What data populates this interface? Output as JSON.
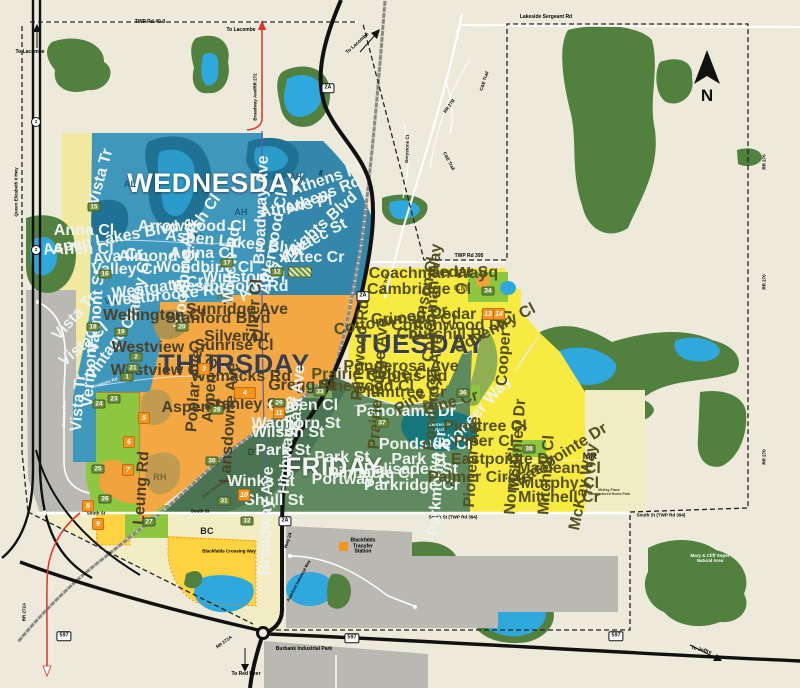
{
  "compass": {
    "label": "N"
  },
  "colors": {
    "background": "#edeadc",
    "wednesday": "#4097bc",
    "thursday": "#f3a844",
    "tuesday": "#f7ea41",
    "friday": "#5f8a5f",
    "forest": "#52803e",
    "water": "#2fa8dd",
    "industrial": "#b9b8b3",
    "lime_zone": "#8dc63f",
    "gold": "#ffd23f",
    "marker_green": "#6f8f3e",
    "marker_orange": "#f7941e",
    "highway": "#111111",
    "route_red": "#e03127"
  },
  "day_labels": [
    {
      "t": "WEDNESDAY",
      "x": 216,
      "y": 183,
      "s": 27,
      "c": "#fcfdfd",
      "k": "day-light"
    },
    {
      "t": "THURSDAY",
      "x": 234,
      "y": 364,
      "s": 27,
      "c": "#3a3d4c",
      "k": "day-dark"
    },
    {
      "t": "TUESDAY",
      "x": 420,
      "y": 344,
      "s": 27,
      "c": "#3a3d4c",
      "k": "day-dark"
    },
    {
      "t": "FRIDAY",
      "x": 334,
      "y": 467,
      "s": 26,
      "c": "#f2f5f1",
      "k": "day-light"
    }
  ],
  "area_labels": [
    {
      "t": "AL",
      "x": 130,
      "y": 184,
      "s": 9,
      "c": "#1d5c7e"
    },
    {
      "t": "AL",
      "x": 199,
      "y": 237,
      "s": 9,
      "c": "#1d5c7e"
    },
    {
      "t": "AH",
      "x": 296,
      "y": 178,
      "s": 8,
      "c": "#1d5c7e"
    },
    {
      "t": "AH",
      "x": 241,
      "y": 212,
      "s": 9,
      "c": "#1d5c7e"
    },
    {
      "t": "VR",
      "x": 111,
      "y": 301,
      "s": 9,
      "c": "#1d5c7e"
    },
    {
      "t": "HM",
      "x": 224,
      "y": 296,
      "s": 9,
      "c": "#7c6a33"
    },
    {
      "t": "RH",
      "x": 160,
      "y": 477,
      "s": 9,
      "c": "#7c6a33"
    },
    {
      "t": "DT",
      "x": 254,
      "y": 452,
      "s": 9,
      "c": "#2e4733"
    },
    {
      "t": "PE",
      "x": 429,
      "y": 404,
      "s": 9,
      "c": "#2e4733"
    },
    {
      "t": "PE",
      "x": 450,
      "y": 483,
      "s": 9,
      "c": "#2e4733"
    },
    {
      "t": "CM",
      "x": 461,
      "y": 288,
      "s": 9,
      "c": "#6e6a2c"
    },
    {
      "t": "MR",
      "x": 590,
      "y": 456,
      "s": 9,
      "c": "#1d1d1b"
    },
    {
      "t": "BC",
      "x": 207,
      "y": 531,
      "s": 9,
      "c": "#1d1d1b"
    }
  ],
  "road_labels": [
    {
      "t": "TWP Rd 40-0",
      "x": 150,
      "y": 23,
      "s": 5
    },
    {
      "t": "To Lacombe",
      "x": 30,
      "y": 53,
      "s": 5
    },
    {
      "t": "To Lacombe",
      "x": 241,
      "y": 31,
      "s": 5
    },
    {
      "t": "To Lacombe",
      "x": 358,
      "y": 44,
      "s": 5,
      "r": -42
    },
    {
      "t": "Lakeside Sergeant Rd",
      "x": 546,
      "y": 18,
      "s": 5
    },
    {
      "t": "C&E Trail",
      "x": 484,
      "y": 81,
      "s": 4.5,
      "r": -72
    },
    {
      "t": "RR 27B",
      "x": 449,
      "y": 106,
      "s": 4.5,
      "r": -55
    },
    {
      "t": "C&E Trail",
      "x": 449,
      "y": 161,
      "s": 4.5,
      "r": 62
    },
    {
      "t": "Greystone Ct",
      "x": 407,
      "y": 149,
      "s": 4.5,
      "r": -88
    },
    {
      "t": "C&E Trail",
      "x": 385,
      "y": 284,
      "s": 4.5,
      "r": -78
    },
    {
      "t": "TWP Rd 395",
      "x": 469,
      "y": 257,
      "s": 5
    },
    {
      "t": "RR 270",
      "x": 764,
      "y": 162,
      "s": 4.5,
      "r": -90
    },
    {
      "t": "RR 270",
      "x": 764,
      "y": 282,
      "s": 4.5,
      "r": -90
    },
    {
      "t": "RR 270",
      "x": 764,
      "y": 457,
      "s": 4.5,
      "r": -90
    },
    {
      "t": "Queen Elizabeth II Hwy",
      "x": 16,
      "y": 192,
      "s": 4.5,
      "r": -90
    },
    {
      "t": "Broadway Ave/RR 272",
      "x": 255,
      "y": 97,
      "s": 4.5,
      "r": -90
    },
    {
      "t": "Hwy 2A",
      "x": 320,
      "y": 178,
      "s": 4.5,
      "r": -80
    },
    {
      "t": "Hwy 2A",
      "x": 288,
      "y": 540,
      "s": 4.5,
      "r": -72
    },
    {
      "t": "South St",
      "x": 52,
      "y": 513,
      "s": 4.5,
      "c": "#ffffff"
    },
    {
      "t": "South St",
      "x": 96,
      "y": 513,
      "s": 4.5
    },
    {
      "t": "South St",
      "x": 200,
      "y": 511,
      "s": 4.5
    },
    {
      "t": "South St (TWP Rd 394)",
      "x": 453,
      "y": 517,
      "s": 4.5
    },
    {
      "t": "South St (TWP Rd 394)",
      "x": 661,
      "y": 515,
      "s": 4.5
    },
    {
      "t": "Blackfalds Crossing Way",
      "x": 229,
      "y": 551,
      "s": 4.5
    },
    {
      "t": "Burbank Industrial Park",
      "x": 304,
      "y": 650,
      "s": 5
    },
    {
      "t": "To Red Deer",
      "x": 246,
      "y": 675,
      "s": 5
    },
    {
      "t": "To Joffre",
      "x": 701,
      "y": 651,
      "s": 5,
      "r": 14
    },
    {
      "t": "RR 272A",
      "x": 24,
      "y": 612,
      "s": 4.5,
      "r": -90
    },
    {
      "t": "RR 272A",
      "x": 224,
      "y": 642,
      "s": 4.5,
      "r": -36
    },
    {
      "t": "Aspelund Industrial Way",
      "x": 299,
      "y": 581,
      "s": 4,
      "r": -62
    },
    {
      "t": "East Railway St",
      "x": 216,
      "y": 487,
      "s": 4.5,
      "r": -36,
      "c": "#4a4128"
    },
    {
      "t": "Duncan Ave",
      "x": 64,
      "y": 414,
      "s": 4.5,
      "r": -88,
      "c": "#ffffff"
    },
    {
      "t": "Womacks Rd",
      "x": 104,
      "y": 383,
      "s": 4.5,
      "r": -18,
      "c": "#eef3f0"
    },
    {
      "t": "Mary & Cliff Soper\nNatural Area",
      "x": 710,
      "y": 558,
      "s": 4.5,
      "c": "#ffffff"
    },
    {
      "t": "Blackfalds\nTransfer\nStation",
      "x": 363,
      "y": 547,
      "s": 5
    },
    {
      "t": "McKay Place\nManufactured Home Park",
      "x": 609,
      "y": 493,
      "s": 3.5,
      "c": "#4a4128"
    },
    {
      "t": "Centennial\nPark",
      "x": 440,
      "y": 427,
      "s": 4.5,
      "c": "#cfe7e3",
      "i": 1
    }
  ],
  "street_labels": [
    {
      "t": "Vista Tr",
      "x": 101,
      "y": 177,
      "r": -75,
      "c": "#eef3f0"
    },
    {
      "t": "Anna Cl",
      "x": 84,
      "y": 231,
      "c": "#eef3f0"
    },
    {
      "t": "Aspen Lakes Blvd",
      "x": 111,
      "y": 239,
      "r": -10,
      "c": "#eef3f0"
    },
    {
      "t": "Arlen Cl",
      "x": 83,
      "y": 250,
      "c": "#eef3f0"
    },
    {
      "t": "Ava Cr",
      "x": 118,
      "y": 257,
      "r": -8,
      "c": "#eef3f0"
    },
    {
      "t": "Valley Cr",
      "x": 125,
      "y": 270,
      "c": "#eef3f0"
    },
    {
      "t": "Valley Cl",
      "x": 139,
      "y": 290,
      "r": -78,
      "c": "#eef3f0"
    },
    {
      "t": "Westgate Cr",
      "x": 158,
      "y": 288,
      "r": -8,
      "c": "#eef3f0"
    },
    {
      "t": "Almond Cr",
      "x": 159,
      "y": 257,
      "c": "#eef3f0"
    },
    {
      "t": "Adina Cl",
      "x": 202,
      "y": 254,
      "c": "#eef3f0"
    },
    {
      "t": "Woodbine Cl",
      "x": 205,
      "y": 268,
      "c": "#eef3f0"
    },
    {
      "t": "Woodbine Ave",
      "x": 185,
      "y": 273,
      "r": -85,
      "c": "#eef3f0"
    },
    {
      "t": "Aspen Lakes Blvd",
      "x": 234,
      "y": 243,
      "r": 6,
      "c": "#eef3f0"
    },
    {
      "t": "Arrowwood Cl",
      "x": 192,
      "y": 227,
      "c": "#eef3f0"
    },
    {
      "t": "Ash Cl",
      "x": 203,
      "y": 217,
      "r": -55,
      "c": "#eef3f0"
    },
    {
      "t": "Willow Rd",
      "x": 232,
      "y": 265,
      "r": -85,
      "c": "#eef3f0"
    },
    {
      "t": "Winston Pl",
      "x": 244,
      "y": 278,
      "c": "#eef3f0"
    },
    {
      "t": "Westbrooke Rd",
      "x": 230,
      "y": 287,
      "c": "#eef3f0"
    },
    {
      "t": "Westbrooke Rd",
      "x": 166,
      "y": 296,
      "r": -6,
      "c": "#eef3f0"
    },
    {
      "t": "Athens Pl",
      "x": 326,
      "y": 180,
      "r": -18,
      "c": "#eef3f0"
    },
    {
      "t": "Athens Rd",
      "x": 323,
      "y": 196,
      "r": -22,
      "c": "#eef3f0"
    },
    {
      "t": "Athens Pl",
      "x": 296,
      "y": 207,
      "r": -10,
      "c": "#eef3f0"
    },
    {
      "t": "Aztec St",
      "x": 318,
      "y": 238,
      "r": -28,
      "c": "#eef3f0"
    },
    {
      "t": "Aztec Cr",
      "x": 312,
      "y": 258,
      "c": "#eef3f0"
    },
    {
      "t": "Aurora Heights Blvd",
      "x": 298,
      "y": 247,
      "r": -42,
      "c": "#eef3f0"
    },
    {
      "t": "Alderwood Cl",
      "x": 274,
      "y": 243,
      "r": -80,
      "c": "#eef3f0"
    },
    {
      "t": "Vista Tr",
      "x": 75,
      "y": 317,
      "r": -48,
      "c": "#eef3f0"
    },
    {
      "t": "Vista Cl",
      "x": 84,
      "y": 345,
      "r": -40,
      "c": "#eef3f0"
    },
    {
      "t": "Vista Tr",
      "x": 79,
      "y": 403,
      "r": -85,
      "c": "#eef3f0"
    },
    {
      "t": "Valmont St",
      "x": 97,
      "y": 311,
      "r": -86,
      "c": "#eef3f0"
    },
    {
      "t": "Vintage Cl",
      "x": 112,
      "y": 347,
      "r": -55,
      "c": "#eef3f0"
    },
    {
      "t": "Vermont Cl",
      "x": 91,
      "y": 365,
      "r": -86,
      "c": "#eef3f0"
    },
    {
      "t": "Broadway Ave",
      "x": 262,
      "y": 210,
      "r": -88,
      "c": "#eef3f0"
    },
    {
      "t": "Wellington Cl",
      "x": 154,
      "y": 316,
      "c": "#4a4128"
    },
    {
      "t": "Westview Cr",
      "x": 159,
      "y": 348,
      "c": "#4a4128"
    },
    {
      "t": "Westview Cr",
      "x": 158,
      "y": 371,
      "c": "#4a4128"
    },
    {
      "t": "Womacks Rd",
      "x": 241,
      "y": 377,
      "c": "#4a4128"
    },
    {
      "t": "Sunridge Ave",
      "x": 237,
      "y": 310,
      "c": "#4a4128"
    },
    {
      "t": "Stanford Blvd",
      "x": 218,
      "y": 319,
      "c": "#4a4128"
    },
    {
      "t": "Silver Dr",
      "x": 237,
      "y": 337,
      "c": "#4a4128"
    },
    {
      "t": "Silver Cl",
      "x": 255,
      "y": 311,
      "r": -86,
      "c": "#4a4128"
    },
    {
      "t": "Sunrise Cl",
      "x": 234,
      "y": 346,
      "c": "#4a4128"
    },
    {
      "t": "Aspen Dr",
      "x": 197,
      "y": 408,
      "c": "#4a4128"
    },
    {
      "t": "Poplar Ave",
      "x": 195,
      "y": 391,
      "r": -86,
      "c": "#4a4128"
    },
    {
      "t": "Aspen Cl",
      "x": 211,
      "y": 388,
      "r": -86,
      "c": "#4a4128"
    },
    {
      "t": "Stanley St",
      "x": 244,
      "y": 405,
      "c": "#4a4128"
    },
    {
      "t": "Lansdowne Ave",
      "x": 230,
      "y": 423,
      "r": -86,
      "c": "#4a4128"
    },
    {
      "t": "Leung Rd",
      "x": 142,
      "y": 488,
      "r": -86,
      "c": "#4a4128"
    },
    {
      "t": "Gregg St",
      "x": 302,
      "y": 386,
      "c": "#4a4128"
    },
    {
      "t": "Waghorn St",
      "x": 296,
      "y": 424,
      "c": "#eef3f0"
    },
    {
      "t": "Wilson St",
      "x": 288,
      "y": 433,
      "c": "#eef3f0"
    },
    {
      "t": "Park St",
      "x": 283,
      "y": 451,
      "c": "#eef3f0"
    },
    {
      "t": "East Ave",
      "x": 298,
      "y": 398,
      "r": -86,
      "c": "#eef3f0"
    },
    {
      "t": "Queen Cl",
      "x": 303,
      "y": 406,
      "c": "#eef3f0"
    },
    {
      "t": "Highway Ave",
      "x": 288,
      "y": 445,
      "r": -86,
      "c": "#eef3f0"
    },
    {
      "t": "Winks St",
      "x": 261,
      "y": 482,
      "c": "#eef3f0"
    },
    {
      "t": "Shull St",
      "x": 274,
      "y": 501,
      "c": "#eef3f0"
    },
    {
      "t": "Broadway Ave",
      "x": 267,
      "y": 521,
      "r": -88,
      "c": "#eef3f0"
    },
    {
      "t": "Panorama Dr",
      "x": 406,
      "y": 412,
      "c": "#eef3f0"
    },
    {
      "t": "Pondside Cr",
      "x": 426,
      "y": 445,
      "c": "#eef3f0"
    },
    {
      "t": "Park St",
      "x": 342,
      "y": 458,
      "c": "#eef3f0"
    },
    {
      "t": "Park St",
      "x": 419,
      "y": 460,
      "c": "#eef3f0"
    },
    {
      "t": "Palisades St",
      "x": 411,
      "y": 470,
      "c": "#eef3f0"
    },
    {
      "t": "Parkridge Cr",
      "x": 412,
      "y": 486,
      "c": "#eef3f0"
    },
    {
      "t": "Pinnacle Cl",
      "x": 371,
      "y": 474,
      "c": "#eef3f0"
    },
    {
      "t": "Portway Cl",
      "x": 353,
      "y": 480,
      "c": "#eef3f0"
    },
    {
      "t": "Parkmount Cr",
      "x": 438,
      "y": 483,
      "r": -86,
      "c": "#eef3f0"
    },
    {
      "t": "Pioneer Way",
      "x": 477,
      "y": 414,
      "r": -48,
      "c": "#eef3f0"
    },
    {
      "t": "Pinetree Cl",
      "x": 485,
      "y": 427,
      "c": "#55511f"
    },
    {
      "t": "Piper Cl",
      "x": 484,
      "y": 442,
      "c": "#55511f"
    },
    {
      "t": "Pioneer Ave",
      "x": 473,
      "y": 462,
      "r": -86,
      "c": "#55511f"
    },
    {
      "t": "Palmer Circle",
      "x": 479,
      "y": 478,
      "c": "#55511f"
    },
    {
      "t": "Coachman Way",
      "x": 428,
      "y": 274,
      "c": "#55511f"
    },
    {
      "t": "Cedar Sq",
      "x": 463,
      "y": 273,
      "c": "#55511f"
    },
    {
      "t": "Cedar Sq",
      "x": 466,
      "y": 315,
      "c": "#55511f"
    },
    {
      "t": "Cambridge Cl",
      "x": 419,
      "y": 290,
      "c": "#55511f"
    },
    {
      "t": "Crimson Cl",
      "x": 425,
      "y": 299,
      "r": -78,
      "c": "#55511f"
    },
    {
      "t": "Crimson Ct",
      "x": 414,
      "y": 320,
      "c": "#55511f"
    },
    {
      "t": "Coachman Way",
      "x": 433,
      "y": 303,
      "r": -86,
      "c": "#55511f"
    },
    {
      "t": "Cottonwood Dr",
      "x": 449,
      "y": 326,
      "c": "#55511f"
    },
    {
      "t": "Cottonwood Dr",
      "x": 391,
      "y": 321,
      "r": -10,
      "c": "#55511f"
    },
    {
      "t": "Churchill Pl",
      "x": 441,
      "y": 335,
      "c": "#55511f"
    },
    {
      "t": "Coventry Cl",
      "x": 495,
      "y": 329,
      "r": -28,
      "c": "#55511f"
    },
    {
      "t": "Cooper Cl",
      "x": 505,
      "y": 348,
      "r": -86,
      "c": "#55511f"
    },
    {
      "t": "Ponderosa Ave",
      "x": 401,
      "y": 367,
      "c": "#55511f"
    },
    {
      "t": "Ponderosa Ave",
      "x": 434,
      "y": 393,
      "r": -86,
      "c": "#55511f"
    },
    {
      "t": "Cyprus Rd",
      "x": 407,
      "y": 377,
      "c": "#55511f"
    },
    {
      "t": "Plumtree Cr",
      "x": 401,
      "y": 393,
      "c": "#55511f"
    },
    {
      "t": "Pinewood Rd",
      "x": 361,
      "y": 350,
      "r": -86,
      "c": "#55511f"
    },
    {
      "t": "Pinewood Cl",
      "x": 366,
      "y": 387,
      "c": "#55511f"
    },
    {
      "t": "Prairie Ridge Cl",
      "x": 371,
      "y": 375,
      "c": "#55511f"
    },
    {
      "t": "Prairie Ridge Ave",
      "x": 379,
      "y": 384,
      "r": -86,
      "c": "#55511f"
    },
    {
      "t": "Pine Cl",
      "x": 419,
      "y": 396,
      "r": -35,
      "c": "#55511f"
    },
    {
      "t": "Pine Cr",
      "x": 451,
      "y": 403,
      "r": -15,
      "c": "#55511f"
    },
    {
      "t": "Eastpointe Dr",
      "x": 503,
      "y": 460,
      "c": "#55511f"
    },
    {
      "t": "Eastpointe Dr",
      "x": 562,
      "y": 455,
      "r": -32,
      "c": "#55511f"
    },
    {
      "t": "Maclean Cl",
      "x": 559,
      "y": 469,
      "c": "#55511f"
    },
    {
      "t": "Murphy Cl",
      "x": 560,
      "y": 484,
      "c": "#55511f"
    },
    {
      "t": "Mitchell Cr",
      "x": 559,
      "y": 498,
      "c": "#55511f"
    },
    {
      "t": "Mitchell Cl",
      "x": 547,
      "y": 475,
      "r": -86,
      "c": "#55511f"
    },
    {
      "t": "Norris Cl",
      "x": 513,
      "y": 481,
      "r": -86,
      "c": "#55511f"
    },
    {
      "t": "McKay Way",
      "x": 584,
      "y": 487,
      "r": -78,
      "c": "#55511f"
    },
    {
      "t": "McKinley Dr",
      "x": 518,
      "y": 445,
      "r": -86,
      "c": "#55511f"
    }
  ],
  "markers": {
    "green": [
      {
        "n": "15",
        "x": 94,
        "y": 207
      },
      {
        "n": "16",
        "x": 105,
        "y": 274
      },
      {
        "n": "17",
        "x": 227,
        "y": 263
      },
      {
        "n": "12",
        "x": 277,
        "y": 272
      },
      {
        "n": "18",
        "x": 93,
        "y": 327
      },
      {
        "n": "19",
        "x": 121,
        "y": 332
      },
      {
        "n": "20",
        "x": 182,
        "y": 327
      },
      {
        "n": "2",
        "x": 136,
        "y": 357
      },
      {
        "n": "21",
        "x": 133,
        "y": 368
      },
      {
        "n": "1",
        "x": 127,
        "y": 377
      },
      {
        "n": "23",
        "x": 114,
        "y": 399
      },
      {
        "n": "24",
        "x": 99,
        "y": 404
      },
      {
        "n": "25",
        "x": 98,
        "y": 469
      },
      {
        "n": "26",
        "x": 105,
        "y": 499
      },
      {
        "n": "27",
        "x": 149,
        "y": 522
      },
      {
        "n": "28",
        "x": 217,
        "y": 410
      },
      {
        "n": "29",
        "x": 279,
        "y": 403
      },
      {
        "n": "30",
        "x": 212,
        "y": 461
      },
      {
        "n": "31",
        "x": 224,
        "y": 501
      },
      {
        "n": "32",
        "x": 247,
        "y": 521
      },
      {
        "n": "33",
        "x": 320,
        "y": 392
      },
      {
        "n": "34",
        "x": 488,
        "y": 291
      },
      {
        "n": "36",
        "x": 463,
        "y": 393
      },
      {
        "n": "37",
        "x": 382,
        "y": 423
      },
      {
        "n": "38",
        "x": 529,
        "y": 449
      }
    ],
    "orange": [
      {
        "n": "3",
        "x": 204,
        "y": 369
      },
      {
        "n": "4",
        "x": 245,
        "y": 393,
        "wd": 20
      },
      {
        "n": "5",
        "x": 144,
        "y": 418
      },
      {
        "n": "6",
        "x": 129,
        "y": 442
      },
      {
        "n": "7",
        "x": 128,
        "y": 470
      },
      {
        "n": "8",
        "x": 88,
        "y": 506
      },
      {
        "n": "9",
        "x": 98,
        "y": 524
      },
      {
        "n": "10",
        "x": 244,
        "y": 495
      },
      {
        "n": "11",
        "x": 279,
        "y": 413
      },
      {
        "n": "13",
        "x": 488,
        "y": 314
      },
      {
        "n": "14",
        "x": 499,
        "y": 314
      }
    ],
    "hatch": [
      {
        "n": "",
        "x": 300,
        "y": 272,
        "wd": 22
      }
    ]
  },
  "shields": [
    {
      "t": "2A",
      "x": 328,
      "y": 88
    },
    {
      "t": "2A",
      "x": 363,
      "y": 296
    },
    {
      "t": "2A",
      "x": 285,
      "y": 521
    },
    {
      "t": "597",
      "x": 64,
      "y": 636
    },
    {
      "t": "597",
      "x": 352,
      "y": 638
    },
    {
      "t": "597",
      "x": 616,
      "y": 636
    },
    {
      "t": "2",
      "x": 36,
      "y": 122,
      "circle": true
    },
    {
      "t": "2",
      "x": 36,
      "y": 250,
      "circle": true
    }
  ]
}
